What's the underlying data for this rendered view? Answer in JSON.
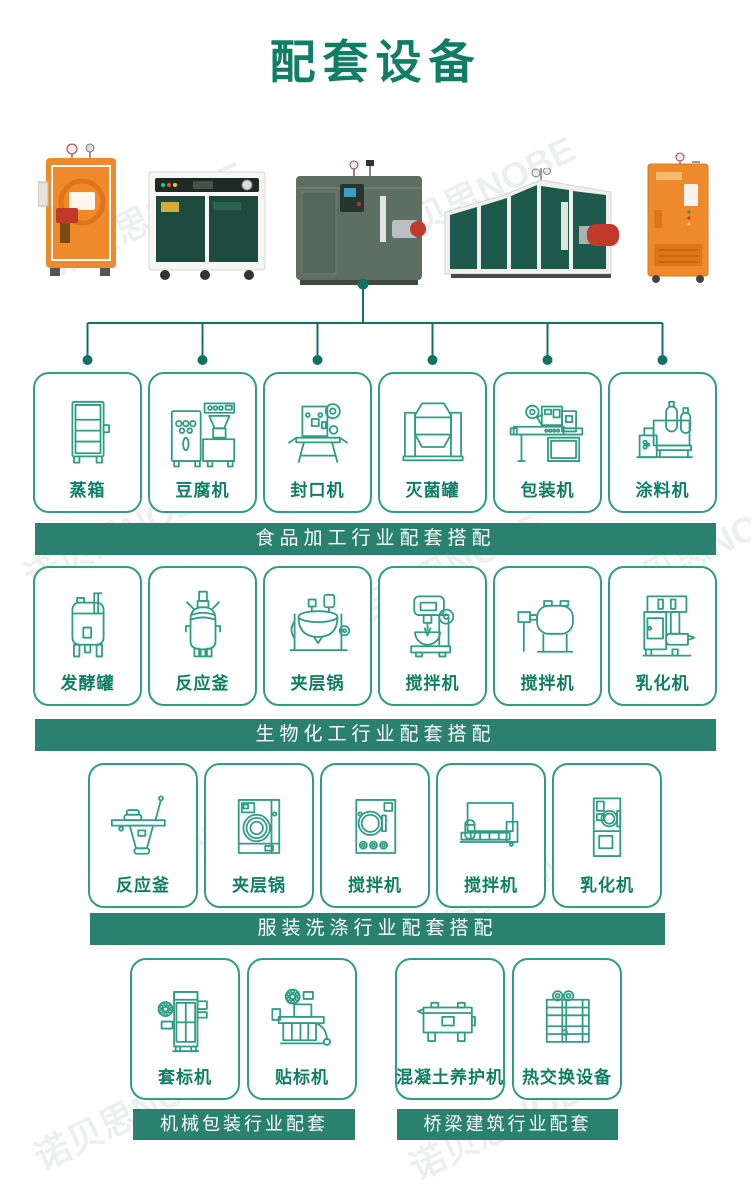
{
  "page": {
    "title": "配套设备",
    "watermark": "诺贝思NOBE",
    "colors": {
      "title_green": "#0f7e64",
      "banner_green": "#2a8170",
      "line_teal": "#2f9c85",
      "connector_teal": "#0f7360",
      "product_orange": "#ef8a2c",
      "product_dark_green": "#1d4a3d",
      "burner_red": "#c0392b"
    }
  },
  "products": [
    {
      "name": "orange-vertical-steam-generator"
    },
    {
      "name": "green-cabinet-steam-generator"
    },
    {
      "name": "green-cube-steam-generator"
    },
    {
      "name": "large-green-steam-boiler-with-burner"
    },
    {
      "name": "orange-cabinet-steam-generator"
    }
  ],
  "groups": [
    {
      "banner": "食品加工行业配套搭配",
      "items": [
        {
          "label": "蒸箱",
          "icon": "steam-cabinet-icon"
        },
        {
          "label": "豆腐机",
          "icon": "tofu-machine-icon"
        },
        {
          "label": "封口机",
          "icon": "sealing-machine-icon"
        },
        {
          "label": "灭菌罐",
          "icon": "sterilizer-tank-icon"
        },
        {
          "label": "包装机",
          "icon": "packaging-machine-icon"
        },
        {
          "label": "涂料机",
          "icon": "coating-machine-icon"
        }
      ]
    },
    {
      "banner": "生物化工行业配套搭配",
      "items": [
        {
          "label": "发酵罐",
          "icon": "fermenter-tank-icon"
        },
        {
          "label": "反应釜",
          "icon": "reactor-kettle-icon"
        },
        {
          "label": "夹层锅",
          "icon": "jacketed-pot-icon"
        },
        {
          "label": "搅拌机",
          "icon": "stand-mixer-icon"
        },
        {
          "label": "搅拌机",
          "icon": "drum-mixer-icon"
        },
        {
          "label": "乳化机",
          "icon": "emulsifier-icon"
        }
      ]
    },
    {
      "banner": "服装洗涤行业配套搭配",
      "items": [
        {
          "label": "反应釜",
          "icon": "ironing-table-icon"
        },
        {
          "label": "夹层锅",
          "icon": "front-washer-icon"
        },
        {
          "label": "搅拌机",
          "icon": "front-washer-2-icon"
        },
        {
          "label": "搅拌机",
          "icon": "flatwork-ironer-icon"
        },
        {
          "label": "乳化机",
          "icon": "dryer-icon"
        }
      ]
    },
    {
      "banner": "机械包装行业配套",
      "items": [
        {
          "label": "套标机",
          "icon": "sleeve-labeler-icon"
        },
        {
          "label": "贴标机",
          "icon": "labeling-machine-icon"
        }
      ]
    },
    {
      "banner": "桥梁建筑行业配套",
      "items": [
        {
          "label": "混凝土养护机",
          "icon": "concrete-curing-box-icon"
        },
        {
          "label": "热交换设备",
          "icon": "heat-exchanger-icon"
        }
      ]
    }
  ]
}
